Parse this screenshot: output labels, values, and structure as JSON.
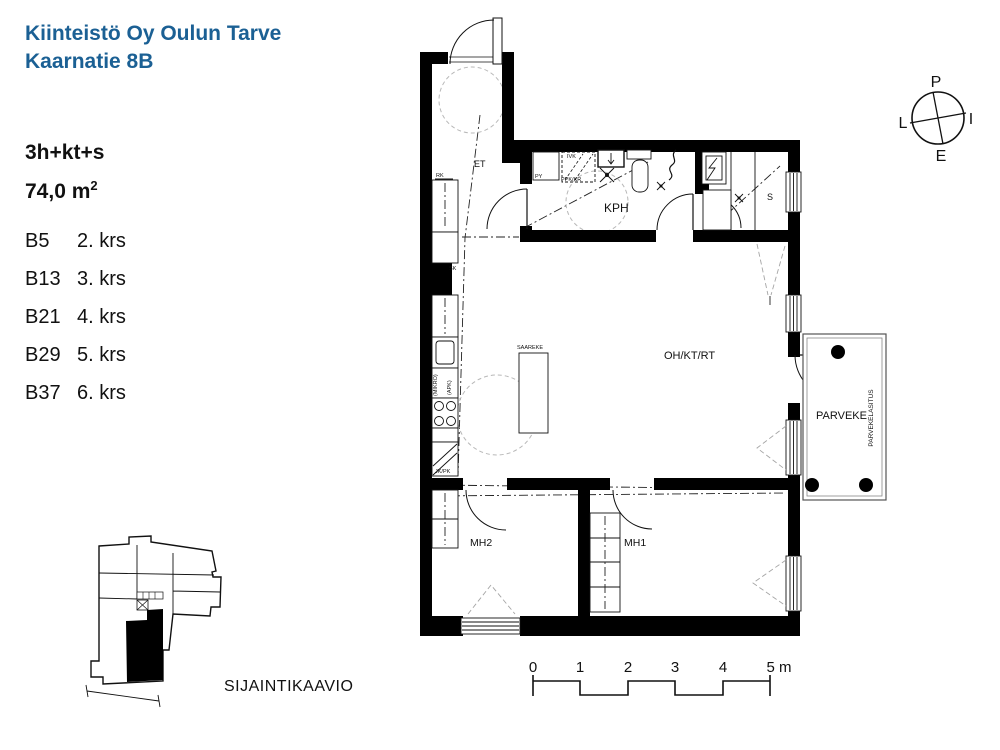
{
  "header": {
    "title_line1": "Kiinteistö Oy Oulun Tarve",
    "title_line2": "Kaarnatie 8B",
    "title_color": "#1b6094"
  },
  "apartment": {
    "layout": "3h+kt+s",
    "area_value": "74,0 m",
    "area_sup": "2"
  },
  "units": [
    {
      "id": "B5",
      "floor": "2. krs"
    },
    {
      "id": "B13",
      "floor": "3. krs"
    },
    {
      "id": "B21",
      "floor": "4. krs"
    },
    {
      "id": "B29",
      "floor": "5. krs"
    },
    {
      "id": "B37",
      "floor": "6. krs"
    }
  ],
  "rooms": {
    "entry": "ET",
    "bathroom": "KPH",
    "sauna": "S",
    "living_kitchen": "OH/KT/RT",
    "bedroom1": "MH1",
    "bedroom2": "MH2",
    "balcony": "PARVEKE",
    "balcony_glazing": "PARVEKELASITUS",
    "kitchen_island": "SAAREKE"
  },
  "fixtures": {
    "rk": "RK",
    "sk": "SK",
    "py": "PY",
    "ivk": "IVK",
    "ppk_kr": "PPK/KR",
    "mikro": "(MIKRO)",
    "apk": "(APK)",
    "jk_pk": "JK/PK"
  },
  "compass": {
    "north": "P",
    "east": "I",
    "south": "E",
    "west": "L"
  },
  "scale_bar": {
    "t0": "0",
    "t1": "1",
    "t2": "2",
    "t3": "3",
    "t4": "4",
    "t5": "5 m"
  },
  "location": {
    "caption": "SIJAINTIKAAVIO"
  },
  "colors": {
    "ink": "#111111",
    "wall": "#000000",
    "title_blue": "#1b6094"
  }
}
